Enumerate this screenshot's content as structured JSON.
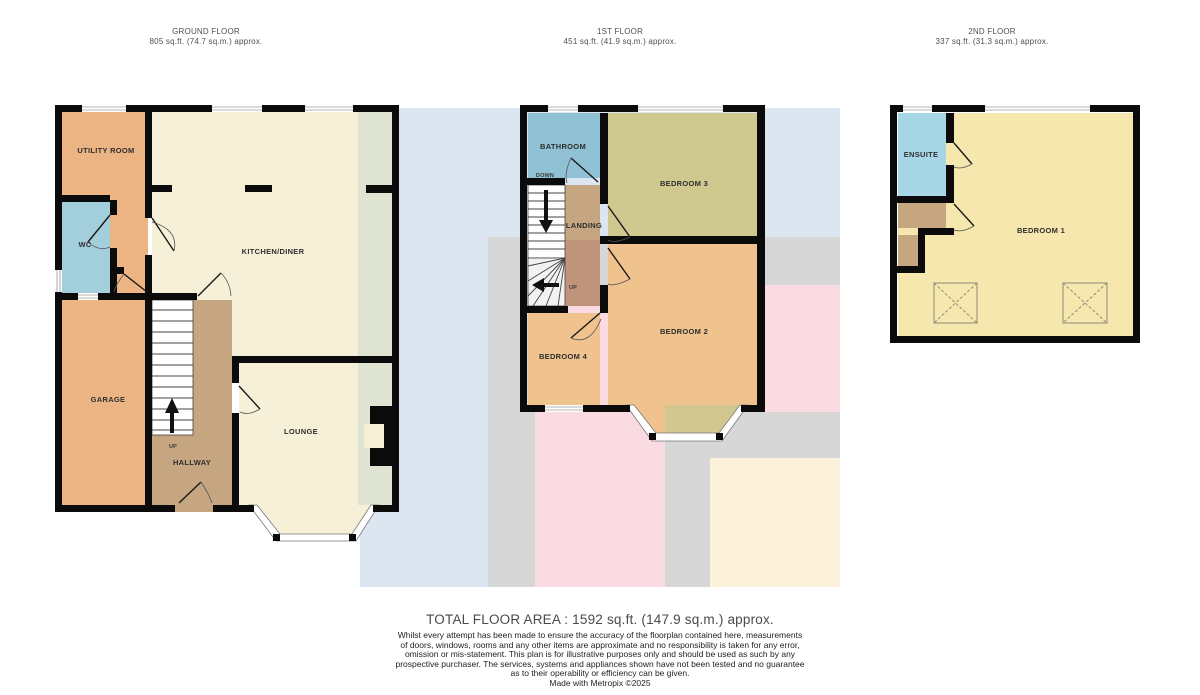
{
  "floors": {
    "ground": {
      "title": "GROUND FLOOR",
      "area": "805 sq.ft. (74.7 sq.m.) approx.",
      "rooms": {
        "utility": "UTILITY ROOM",
        "wc": "WC",
        "kitchen": "KITCHEN/DINER",
        "garage": "GARAGE",
        "hallway": "HALLWAY",
        "lounge": "LOUNGE",
        "up": "UP"
      }
    },
    "first": {
      "title": "1ST FLOOR",
      "area": "451 sq.ft. (41.9 sq.m.) approx.",
      "rooms": {
        "bathroom": "BATHROOM",
        "down": "DOWN",
        "landing": "LANDING",
        "up": "UP",
        "bedroom3": "BEDROOM 3",
        "bedroom2": "BEDROOM 2",
        "bedroom4": "BEDROOM 4"
      }
    },
    "second": {
      "title": "2ND FLOOR",
      "area": "337 sq.ft. (31.3 sq.m.) approx.",
      "rooms": {
        "ensuite": "ENSUITE",
        "bedroom1": "BEDROOM 1"
      }
    }
  },
  "footer": {
    "total": "TOTAL FLOOR AREA : 1592 sq.ft. (147.9 sq.m.) approx.",
    "disclaimer_lines": [
      "Whilst every attempt has been made to ensure the accuracy of the floorplan contained here, measurements",
      "of doors, windows, rooms and any other items are approximate and no responsibility is taken for any error,",
      "omission or mis-statement. This plan is for illustrative purposes only and should be used as such by any",
      "prospective purchaser. The services, systems and appliances shown have not been tested and no guarantee",
      "as to their operability or efficiency can be given."
    ],
    "credit": "Made with Metropix ©2025"
  },
  "colors": {
    "wall": "#0b0b0b",
    "orange_room": "#ecb483",
    "bedroom_orange": "#f0c28e",
    "tan_hall": "#c6a681",
    "tan_landing_dark": "#bf947b",
    "cream_room": "#f6f0d8",
    "green_strip": "#dfe3d1",
    "wc_blue": "#a3cfdc",
    "bathroom_blue": "#8fc0d4",
    "ensuite_blue": "#a7d7e6",
    "bedroom3_olive": "#cfc98f",
    "bedroom1_yellow": "#f5e7ae",
    "bg_blue": "#dbe6f1",
    "bg_gray": "#d7d7d7",
    "bg_pink": "#fbdbe2",
    "bg_beige": "#fcf2dc"
  }
}
